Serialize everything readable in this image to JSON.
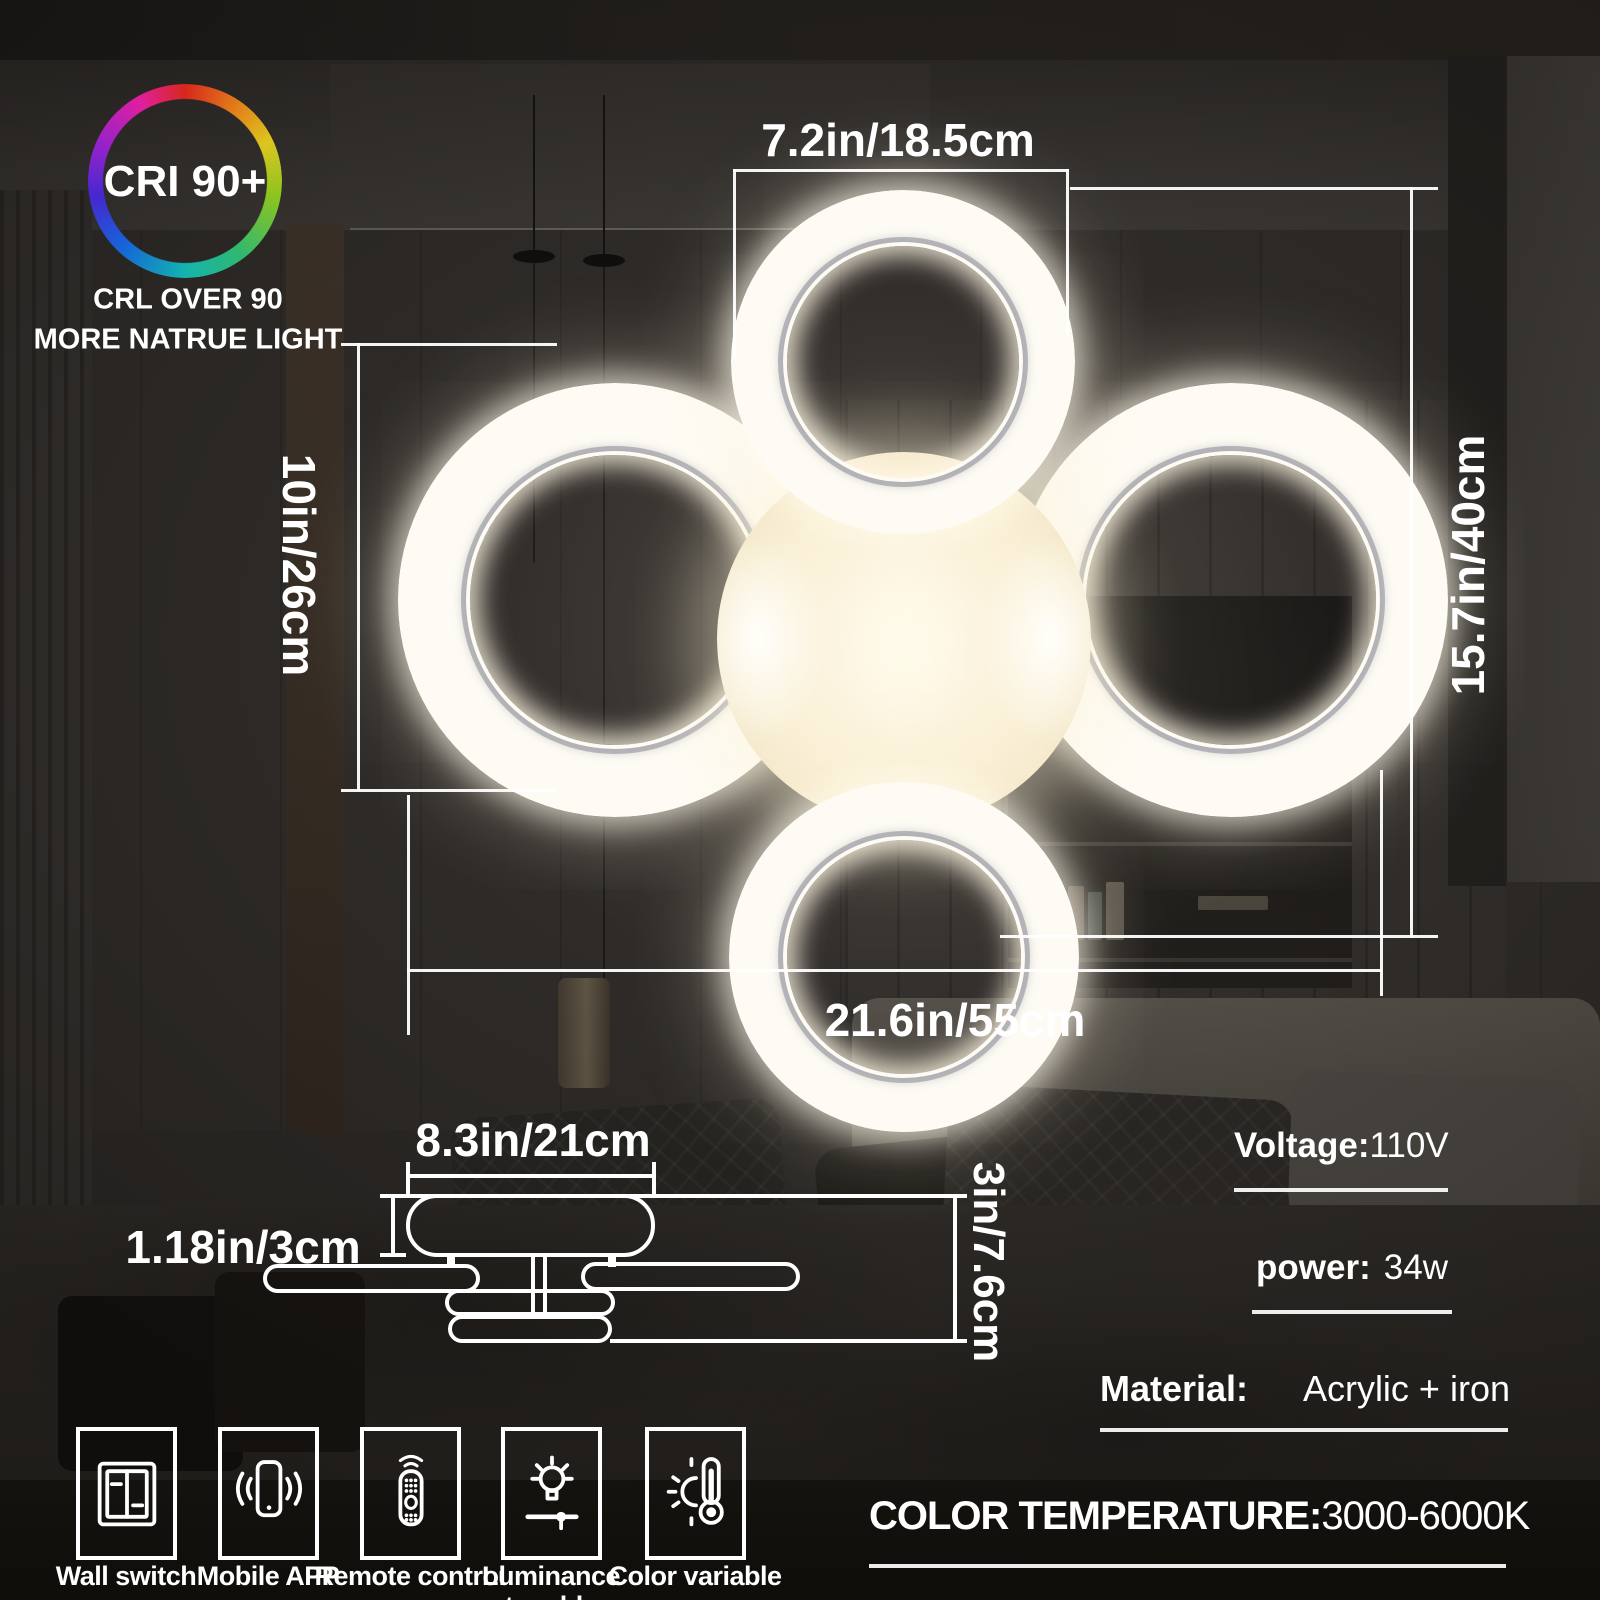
{
  "badge": {
    "title": "CRI 90+",
    "line1": "CRL OVER 90",
    "line2": "MORE NATRUE LIGHT"
  },
  "dims": {
    "top_ring_diameter": "7.2in/18.5cm",
    "left_height": "10in/26cm",
    "right_height": "15.7in/40cm",
    "overall_width": "21.6in/55cm",
    "base_width": "8.3in/21cm",
    "base_thickness": "1.18in/3cm",
    "side_height": "3in/7.6cm"
  },
  "specs": {
    "voltage": {
      "label": "Voltage:",
      "value": "110V"
    },
    "power": {
      "label": "power:",
      "value": "34w"
    },
    "material": {
      "label": "Material:",
      "value": "Acrylic + iron"
    },
    "color_temperature": {
      "label": "COLOR TEMPERATURE:",
      "value": "3000-6000K"
    }
  },
  "features": [
    {
      "icon": "wall-switch-icon",
      "label": "Wall switch"
    },
    {
      "icon": "mobile-app-icon",
      "label": "Mobile APP"
    },
    {
      "icon": "remote-control-icon",
      "label": "Remote control"
    },
    {
      "icon": "luminance-tunable-icon",
      "label": "Luminance tunable"
    },
    {
      "icon": "color-variable-icon",
      "label": "Color variable"
    }
  ],
  "colors": {
    "annotation": "#ffffff",
    "ring_glow": "#fdfbf4",
    "warm_center": "#f2e5c6",
    "background_wall": "#3f3b38"
  }
}
